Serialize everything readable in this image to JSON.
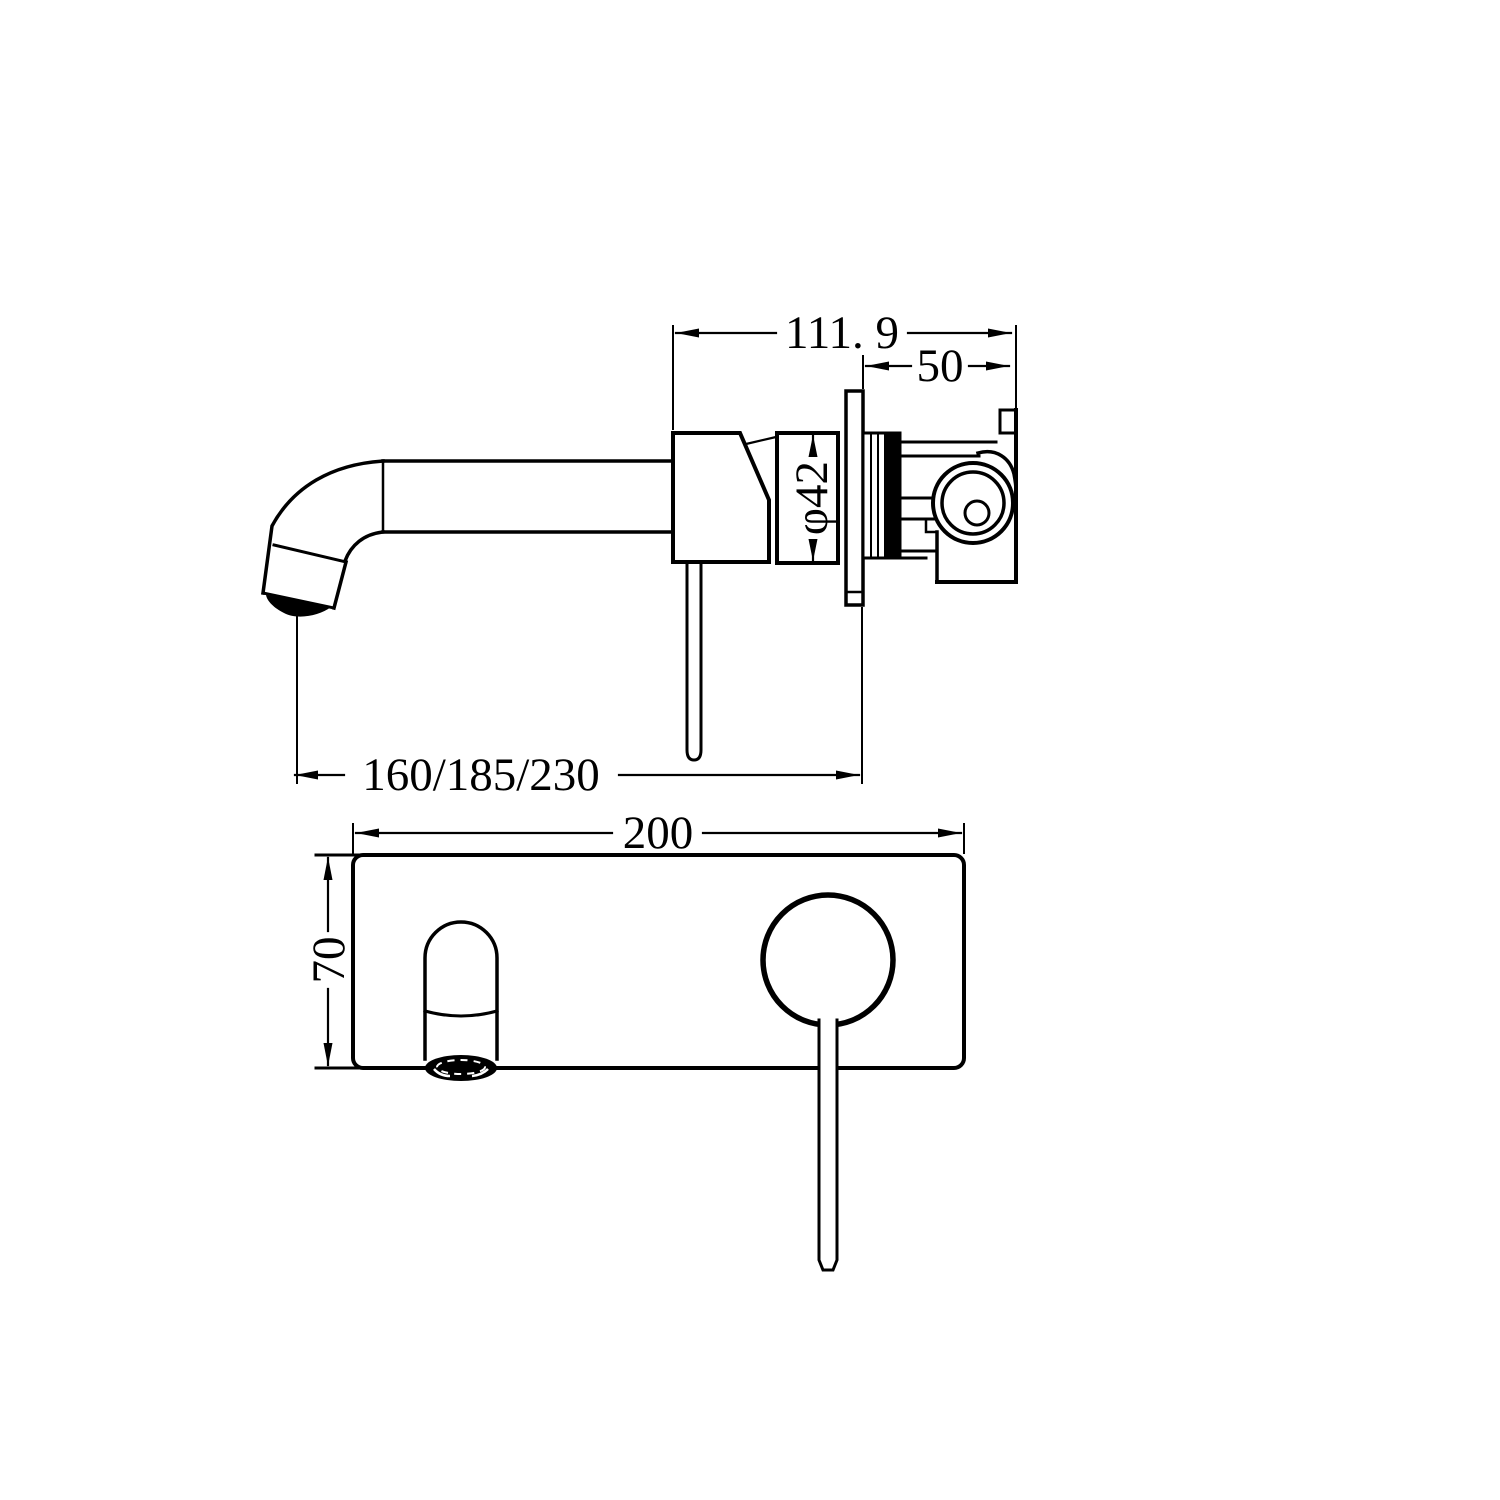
{
  "drawing": {
    "type": "wall-mixer-technical-drawing",
    "views": {
      "side_view_name": "side elevation",
      "front_view_name": "front elevation"
    },
    "dimensions": {
      "overall_depth": "111. 9",
      "behind_wall_depth": "50",
      "body_diameter": "φ42",
      "spout_reach_options": "160/185/230",
      "plate_width": "200",
      "plate_height": "70"
    },
    "colors": {
      "line": "#000000",
      "background": "#ffffff"
    }
  }
}
